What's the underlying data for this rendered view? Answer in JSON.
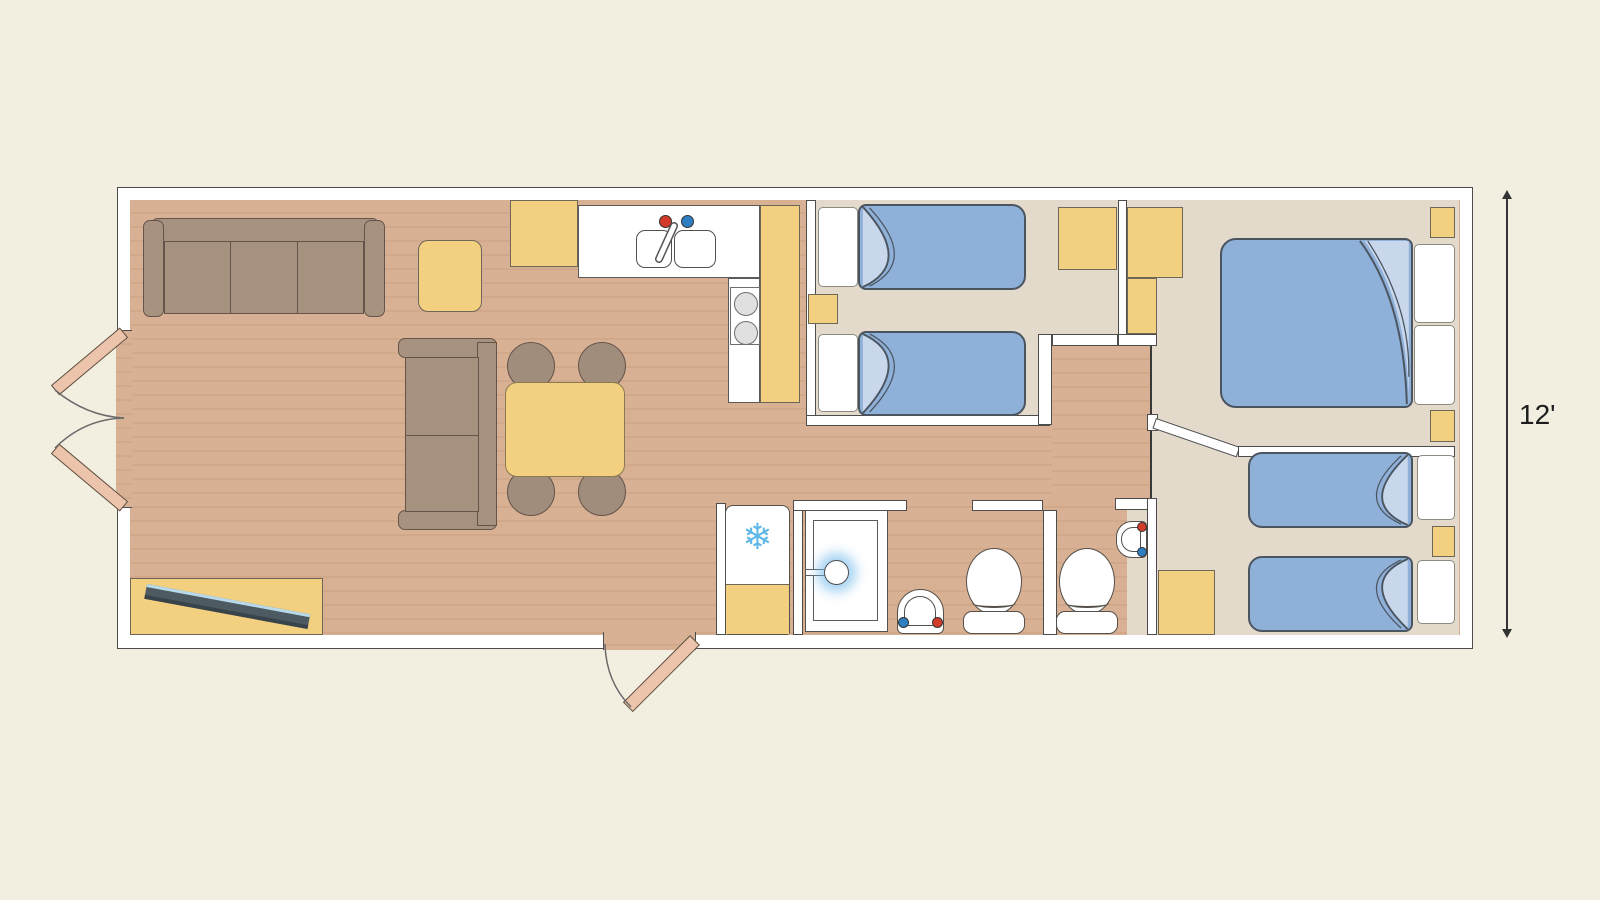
{
  "dimension": {
    "label": "12'"
  },
  "icons": {
    "freezer_snowflake": "❄"
  },
  "colors": {
    "background": "#f2efe1",
    "wall": "#ffffff",
    "wood_floor": "#d8b194",
    "carpet": "#e4dacc",
    "cabinet_yellow": "#f3cf80",
    "bed_blue": "#8fb0d8",
    "bed_fold_blue": "#c9d7ed",
    "sofa_brown": "#a7927f",
    "door_leaf_tan": "#ecc3ab",
    "hot_tap_red": "#d23b2a",
    "cold_tap_blue": "#2e7fc1",
    "snowflake_blue": "#5fb8e6"
  }
}
